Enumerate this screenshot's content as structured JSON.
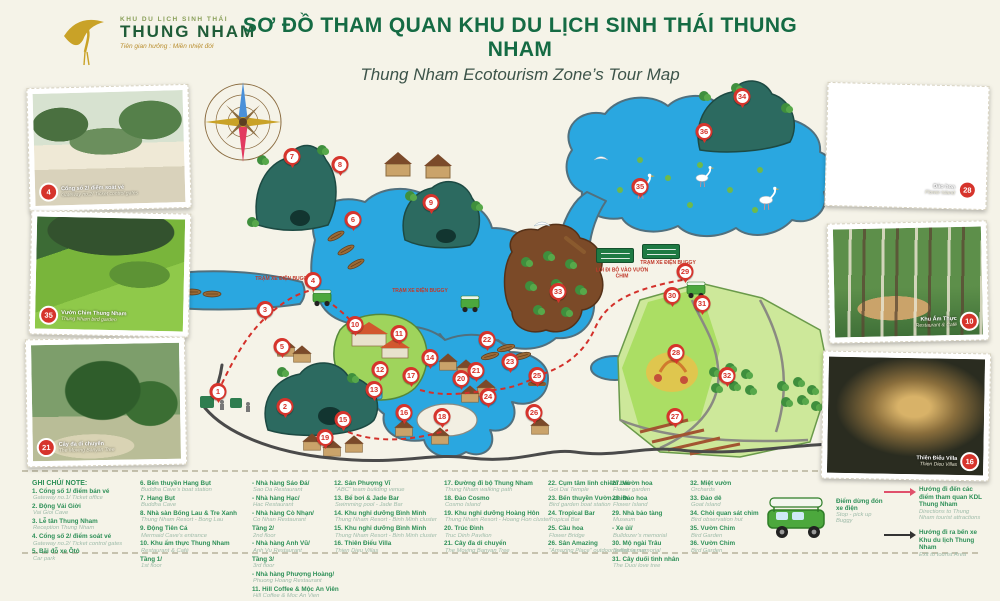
{
  "header": {
    "logo_small": "KHU DU LỊCH SINH THÁI",
    "logo_name": "THUNG NHAM",
    "logo_tagline": "Tiên gian hưởng : Miền nhiệt đới",
    "title": "SƠ ĐỒ THAM QUAN KHU DU LỊCH SINH THÁI THUNG NHAM",
    "subtitle": "Thung Nham Ecotourism Zone’s Tour Map"
  },
  "colors": {
    "title_green": "#156b44",
    "legend_green": "#2e9058",
    "marker_red": "#d6342c",
    "water_blue": "#2aa7e0",
    "route_red": "#d3302a",
    "road_gray": "#4a4a4a",
    "arrow_red": "#e0506b",
    "arrow_black": "#333333"
  },
  "map": {
    "markers": [
      {
        "n": 1,
        "x": 218,
        "y": 400
      },
      {
        "n": 2,
        "x": 285,
        "y": 415
      },
      {
        "n": 3,
        "x": 265,
        "y": 318
      },
      {
        "n": 4,
        "x": 313,
        "y": 289
      },
      {
        "n": 5,
        "x": 282,
        "y": 355
      },
      {
        "n": 6,
        "x": 353,
        "y": 228
      },
      {
        "n": 7,
        "x": 292,
        "y": 165
      },
      {
        "n": 8,
        "x": 340,
        "y": 173
      },
      {
        "n": 9,
        "x": 431,
        "y": 211
      },
      {
        "n": 10,
        "x": 355,
        "y": 333
      },
      {
        "n": 11,
        "x": 399,
        "y": 342
      },
      {
        "n": 12,
        "x": 380,
        "y": 378
      },
      {
        "n": 13,
        "x": 374,
        "y": 398
      },
      {
        "n": 14,
        "x": 430,
        "y": 366
      },
      {
        "n": 15,
        "x": 343,
        "y": 428
      },
      {
        "n": 16,
        "x": 404,
        "y": 421
      },
      {
        "n": 17,
        "x": 411,
        "y": 384
      },
      {
        "n": 18,
        "x": 442,
        "y": 425
      },
      {
        "n": 19,
        "x": 325,
        "y": 446
      },
      {
        "n": 20,
        "x": 461,
        "y": 387
      },
      {
        "n": 21,
        "x": 476,
        "y": 379
      },
      {
        "n": 22,
        "x": 487,
        "y": 348
      },
      {
        "n": 23,
        "x": 510,
        "y": 370
      },
      {
        "n": 24,
        "x": 488,
        "y": 405
      },
      {
        "n": 25,
        "x": 537,
        "y": 384
      },
      {
        "n": 26,
        "x": 534,
        "y": 421
      },
      {
        "n": 27,
        "x": 675,
        "y": 425
      },
      {
        "n": 28,
        "x": 676,
        "y": 361
      },
      {
        "n": 29,
        "x": 685,
        "y": 280
      },
      {
        "n": 30,
        "x": 672,
        "y": 304
      },
      {
        "n": 31,
        "x": 702,
        "y": 312
      },
      {
        "n": 32,
        "x": 727,
        "y": 384
      },
      {
        "n": 33,
        "x": 558,
        "y": 300
      },
      {
        "n": 34,
        "x": 742,
        "y": 105
      },
      {
        "n": 35,
        "x": 640,
        "y": 195
      },
      {
        "n": 36,
        "x": 704,
        "y": 140
      }
    ],
    "labels": [
      {
        "text": "TRẠM XE ĐIỆN BUGGY",
        "x": 283,
        "y": 280
      },
      {
        "text": "TRẠM XE ĐIỆN BUGGY",
        "x": 420,
        "y": 292
      },
      {
        "text": "LỐI ĐI BỘ VÀO VƯỜN CHIM",
        "x": 622,
        "y": 274
      },
      {
        "text": "TRẠM XE ĐIỆN BUGGY",
        "x": 668,
        "y": 264
      }
    ]
  },
  "photos": [
    {
      "id": "gate",
      "n": "4",
      "vn": "Cổng số 2/ điểm soát vé",
      "en": "Gateway no.2/ Ticket control gates",
      "scene": "scene-gate"
    },
    {
      "id": "bird-garden",
      "n": "35",
      "vn": "Vườn Chim Thung Nham",
      "en": "Thung Nham bird garden",
      "scene": "scene-valley"
    },
    {
      "id": "banyan",
      "n": "21",
      "vn": "Cây đa di chuyển",
      "en": "The Moving Banyan Tree",
      "scene": "scene-banyan"
    },
    {
      "id": "flower-island",
      "n": "28",
      "vn": "Đảo hoa",
      "en": "Flower Island",
      "scene": "scene-flower-island"
    },
    {
      "id": "restaurant",
      "n": "10",
      "vn": "Khu Ẩm Thực",
      "en": "Restaurant & Café",
      "scene": "scene-forest-cafe"
    },
    {
      "id": "villa",
      "n": "16",
      "vn": "Thiên Điểu Villa",
      "en": "Thien Dieu Villas",
      "scene": "scene-night-villa"
    }
  ],
  "legend": {
    "title": "GHI CHÚ/ NOTE:",
    "columns": [
      {
        "items": [
          {
            "vn": "1. Cổng số 1/ điểm bán vé",
            "en": "Gateway no.1/ Ticket office"
          },
          {
            "vn": "2. Động Vái Giời",
            "en": "Vai Gioi Cave"
          },
          {
            "vn": "3. Lễ tân Thung Nham",
            "en": "Reception Thung Nham"
          },
          {
            "vn": "4. Cổng số 2/ điểm soát vé",
            "en": "Gateway no.2/ Ticket control gates"
          },
          {
            "vn": "5. Bãi đỗ xe Ôtô",
            "en": "Car park"
          }
        ]
      },
      {
        "items": [
          {
            "vn": "6. Bến thuyền Hang Bụt",
            "en": "Buddha Cave’s boat station"
          },
          {
            "vn": "7. Hang Bụt",
            "en": "Buddha Cave"
          },
          {
            "vn": "8. Nhà sàn Bống Lau & Tre Xanh",
            "en": "Thung Nham Resort - Bong Lau"
          },
          {
            "vn": "9. Động Tiên Cá",
            "en": "Mermaid Cave’s entrance"
          },
          {
            "vn": "10. Khu ẩm thực Thung Nham",
            "en": "Restaurant & Café"
          },
          {
            "vn": "Tầng 1/",
            "en": "1st floor"
          }
        ]
      },
      {
        "items": [
          {
            "vn": "- Nhà hàng Sáo Đá/",
            "en": "Sao Da Restaurant"
          },
          {
            "vn": "- Nhà hàng Hạc/",
            "en": "Hac Restaurant"
          },
          {
            "vn": "- Nhà hàng Cò Nhạn/",
            "en": "Co Nhan Restaurant"
          },
          {
            "vn": "Tầng 2/",
            "en": "2nd floor"
          },
          {
            "vn": "- Nhà hàng Anh Vũ/",
            "en": "Anh Vu Restaurant"
          },
          {
            "vn": "Tầng 3/",
            "en": "3rd floor"
          },
          {
            "vn": "- Nhà hàng Phượng Hoàng/",
            "en": "Phuong Hoang Restaurant"
          },
          {
            "vn": "11. Hill Coffee & Mộc An Viên",
            "en": "Hill Coffee & Moc An Vien"
          }
        ]
      },
      {
        "items": [
          {
            "vn": "12. Sân Phượng Vĩ",
            "en": "\"ABC\" team building venue"
          },
          {
            "vn": "13. Bể bơi & Jade Bar",
            "en": "Swimming pool - Jade Bar"
          },
          {
            "vn": "14. Khu nghỉ dưỡng Bình Minh",
            "en": "Thung Nham Resort - Binh Minh cluster"
          },
          {
            "vn": "15. Khu nghỉ dưỡng Bình Minh",
            "en": "Thung Nham Resort - Binh Minh cluster"
          },
          {
            "vn": "16. Thiên Điểu Villa",
            "en": "Thien Dieu Villas"
          }
        ]
      },
      {
        "items": [
          {
            "vn": "17. Đường đi bộ Thung Nham",
            "en": "Thung Nham walking path"
          },
          {
            "vn": "18. Đảo Cosmo",
            "en": "Cosmo Island"
          },
          {
            "vn": "19. Khu nghỉ dưỡng Hoàng Hôn",
            "en": "Thung Nham Resort - Hoang Hon cluster"
          },
          {
            "vn": "20. Trúc Đình",
            "en": "Truc Dinh Pavilion"
          },
          {
            "vn": "21. Cây đa di chuyển",
            "en": "The Moving Banyan Tree"
          }
        ]
      },
      {
        "items": [
          {
            "vn": "22. Cụm tâm linh chiêm bái",
            "en": "Goi Dai Temple"
          },
          {
            "vn": "23. Bến thuyền Vườn chim",
            "en": "Bird garden boat station"
          },
          {
            "vn": "24. Tropical Bar",
            "en": "Tropical Bar"
          },
          {
            "vn": "25. Cầu hoa",
            "en": "Flower Bridge"
          },
          {
            "vn": "26. Sân Amazing",
            "en": "\"Amazing Place\" outdoor event venue"
          }
        ]
      },
      {
        "items": [
          {
            "vn": "27. Vườn hoa",
            "en": "Flower garden"
          },
          {
            "vn": "28. Đảo hoa",
            "en": "Flower Island"
          },
          {
            "vn": "29. Nhà bảo tàng",
            "en": "Museum"
          },
          {
            "vn": "- Xe ủi/",
            "en": "Bulldozer’s memorial"
          },
          {
            "vn": "30. Mộ ngài Trâu",
            "en": "Buffalo’s memorial"
          },
          {
            "vn": "31. Cây duối tình nhân",
            "en": "The Duoi love tree"
          }
        ]
      },
      {
        "items": [
          {
            "vn": "32. Miệt vườn",
            "en": "Orchards"
          },
          {
            "vn": "33. Đảo dê",
            "en": "Goat Island"
          },
          {
            "vn": "34. Chòi quan sát chim",
            "en": "Bird observation hut"
          },
          {
            "vn": "35. Vườn Chim",
            "en": "Bird Garden"
          },
          {
            "vn": "36. Vườn Chim",
            "en": "Bird Garden"
          }
        ]
      }
    ],
    "buggy_note": {
      "vn": "Điểm dừng đón xe điện",
      "en": "Stop - pick up Buggy"
    },
    "arrows": [
      {
        "vn": "Hướng đi đến các điểm tham quan KDL Thung Nham",
        "en": "Directions to Thung Nham tourist attractions"
      },
      {
        "vn": "Hướng đi ra bến xe Khu du lịch Thung Nham",
        "en": "Exit to tourist Area"
      }
    ]
  }
}
